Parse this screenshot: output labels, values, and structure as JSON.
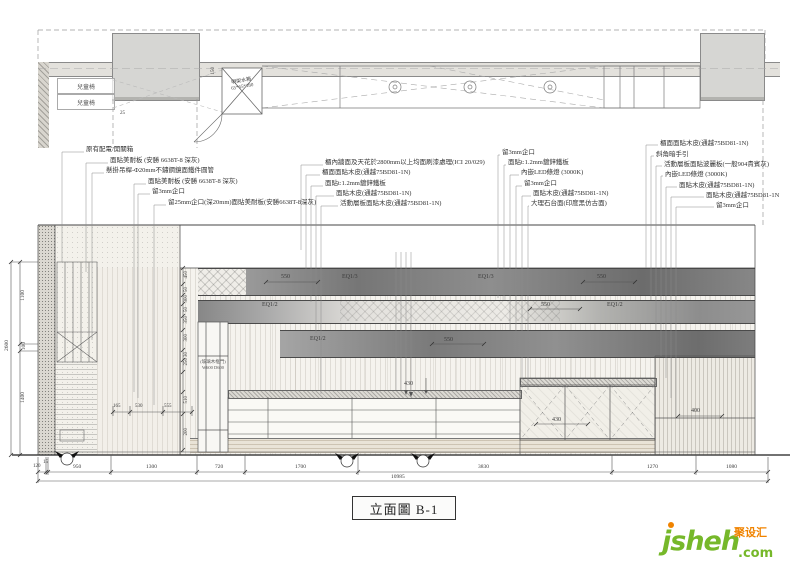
{
  "drawing": {
    "title": "立面圖 B-1"
  },
  "logo": {
    "main": "jsheh",
    "com": ".com",
    "cn": "聚设汇",
    "green": "#76b82a",
    "orange": "#f08300"
  },
  "plan": {
    "chair_1": "兒童椅",
    "chair_2": "兒童椅",
    "tank_line1": "明架水箱",
    "tank_line2": "65*65*180",
    "dim_150": "150",
    "dim_25": "25"
  },
  "annotations": {
    "left": [
      "原有配電/開關箱",
      "面貼美耐板 (安勝 6638T-8 深灰)",
      "懸掛吊桿-Φ20mm不鏽鋼鏡面鐵件圓管",
      "面貼美耐板 (安勝 6638T-8 深灰)",
      "留3mm企口",
      "留25mm企口(深20mm)面貼美耐板(安勝6638T-8深灰)"
    ],
    "middle": [
      "櫃內牆面及天花於2800mm以上均面刷漆處理(ICI 20/029)",
      "櫃面面貼木皮(通越75BD81-1N)",
      "面貼t:1.2mm鍍鋅鐵板",
      "面貼木皮(通越75BD81-1N)",
      "活動層板面貼木皮(通越75BD81-1N)"
    ],
    "right_a": [
      "留3mm企口",
      "面貼t:1.2mm鍍鋅鐵板",
      "內嵌LED條燈 (3000K)",
      "留3mm企口",
      "面貼木皮(通越75BD81-1N)",
      "大理石台面(印度黑仿古面)"
    ],
    "right_b": [
      "櫃面面貼木皮(通越75BD81-1N)",
      "斜角暗手引",
      "活動層板面貼波麗板(一般904貴賓灰)",
      "內嵌LED條燈 (3000K)",
      "面貼木皮(通越75BD81-1N)",
      "面貼木皮(通越75BD81-1N",
      "留3mm企口"
    ]
  },
  "elevation": {
    "band_a": {
      "dim_left": "550",
      "eq_1": "EQ1/3",
      "eq_2": "EQ1/3",
      "dim_right": "550"
    },
    "band_b": {
      "eq_left": "EQ1/2",
      "dim": "550",
      "eq_right": "EQ1/2"
    },
    "band_c": {
      "eq": "EQ1/2",
      "dim": "550"
    },
    "cabinet_label_1": "(玻璃木框門)",
    "cabinet_label_2": "W600 D600",
    "dim_430_top": "430",
    "dim_430_doors": "430",
    "dim_400": "400",
    "left_chain": [
      "450",
      "50",
      "300",
      "50",
      "350",
      "300",
      "30",
      "250",
      "510",
      "200"
    ],
    "mini_chain": [
      "165",
      "530",
      "555"
    ]
  },
  "dimensions": {
    "far_left": {
      "overall": "2600",
      "seg_1": "1100",
      "seg_2": "100",
      "seg_3": "1400"
    },
    "bottom": {
      "overall": "10985",
      "segments": [
        "120",
        "15",
        "950",
        "1300",
        "720",
        "1700",
        "3830",
        "1270",
        "1080"
      ]
    }
  }
}
